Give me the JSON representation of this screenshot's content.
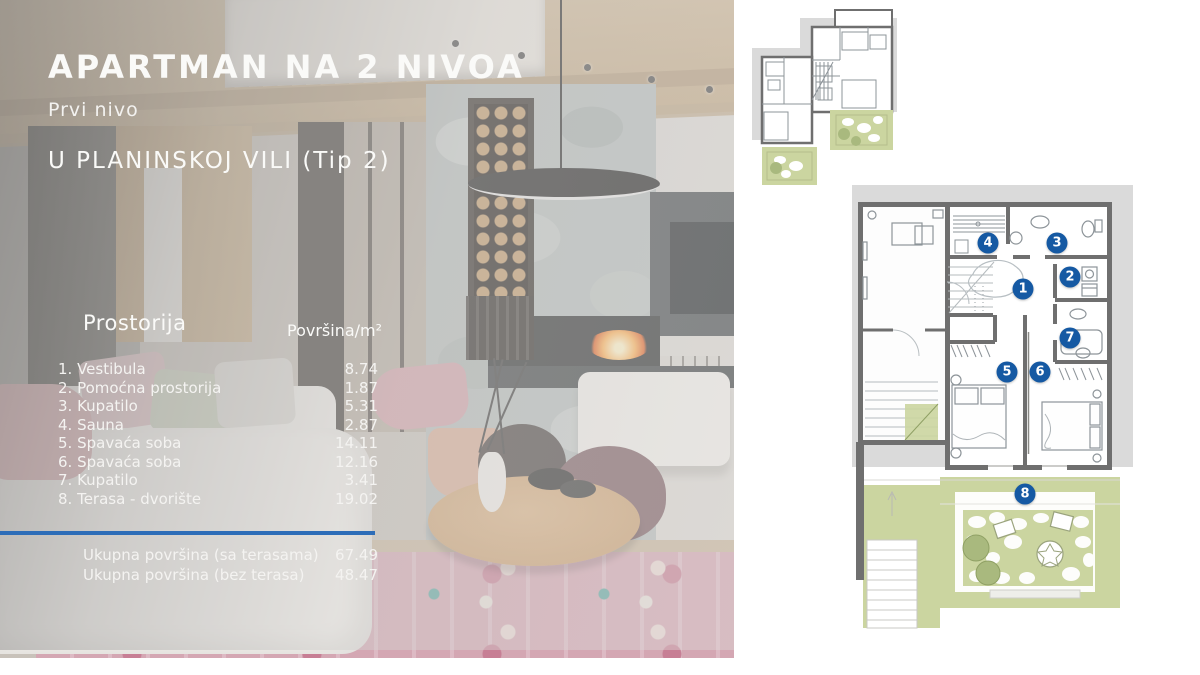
{
  "slide": {
    "title": "APARTMAN NA 2 NIVOA",
    "subtitle": "Prvi nivo",
    "subtitle2": "U PLANINSKOJ VILI (Tip 2)"
  },
  "table": {
    "header": {
      "room": "Prostorija",
      "area": "Površina/m²"
    },
    "rows": [
      {
        "name": "1. Vestibula",
        "area": "8.74"
      },
      {
        "name": "2. Pomoćna prostorija",
        "area": "1.87"
      },
      {
        "name": "3. Kupatilo",
        "area": "5.31"
      },
      {
        "name": "4. Sauna",
        "area": "2.87"
      },
      {
        "name": "5. Spavaća soba",
        "area": "14.11"
      },
      {
        "name": "6. Spavaća soba",
        "area": "12.16"
      },
      {
        "name": "7. Kupatilo",
        "area": "3.41"
      },
      {
        "name": "8. Terasa - dvorište",
        "area": "19.02"
      }
    ],
    "totals": [
      {
        "label": "Ukupna površina (sa terasama)",
        "value": "67.49"
      },
      {
        "label": "Ukupna površina (bez terasa)",
        "value": "48.47"
      }
    ]
  },
  "floor_plan": {
    "markers": [
      {
        "number": "1",
        "x": 1023,
        "y": 289
      },
      {
        "number": "2",
        "x": 1070,
        "y": 277
      },
      {
        "number": "3",
        "x": 1057,
        "y": 243
      },
      {
        "number": "4",
        "x": 988,
        "y": 243
      },
      {
        "number": "5",
        "x": 1007,
        "y": 372
      },
      {
        "number": "6",
        "x": 1040,
        "y": 372
      },
      {
        "number": "7",
        "x": 1070,
        "y": 338
      },
      {
        "number": "8",
        "x": 1025,
        "y": 494
      }
    ]
  },
  "colors": {
    "accent_blue": "#2d6db8",
    "marker_blue": "#1559a3",
    "plan_green": "#cbd5a0",
    "plan_green_dark": "#a9b97e",
    "backdrop_grey": "#dadada",
    "wall_grey": "#6f6f6f"
  }
}
